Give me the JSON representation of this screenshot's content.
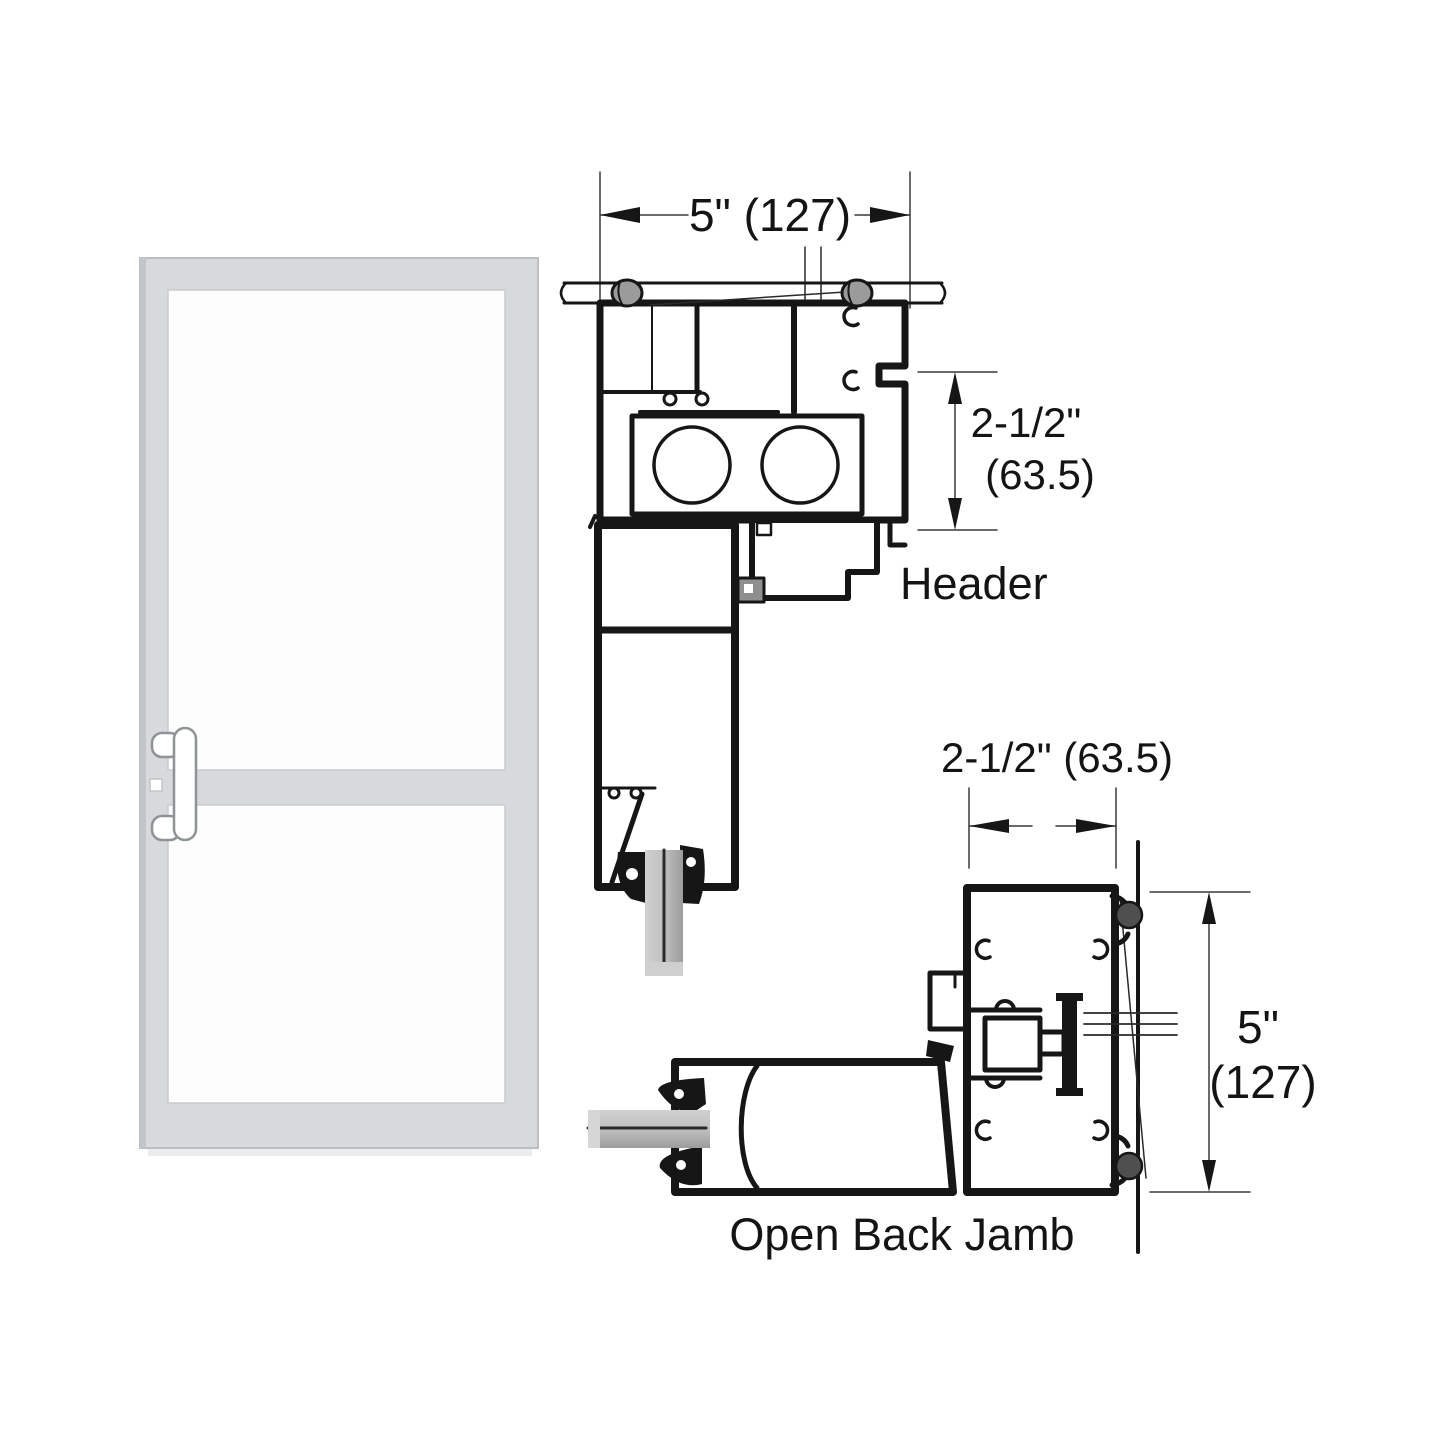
{
  "drawing": {
    "header_detail": {
      "label": "Header",
      "width_dim": "5\" (127)",
      "height_dim_line1": "2-1/2\"",
      "height_dim_line2": "(63.5)"
    },
    "jamb_detail": {
      "label": "Open Back Jamb",
      "width_dim": "2-1/2\" (63.5)",
      "height_dim_line1": "5\"",
      "height_dim_line2": "(127)"
    }
  },
  "colors": {
    "line": "#161616",
    "dim_line": "#3a3a3a",
    "door_frame": "#d7d9da",
    "door_frame_edge": "#c3c6c8",
    "glass_white": "#fdfdfd",
    "screw_gray": "#9b9b9b",
    "gasket_dark": "#4f4f4f",
    "glass_bar_mid": "#b9b9b9"
  }
}
